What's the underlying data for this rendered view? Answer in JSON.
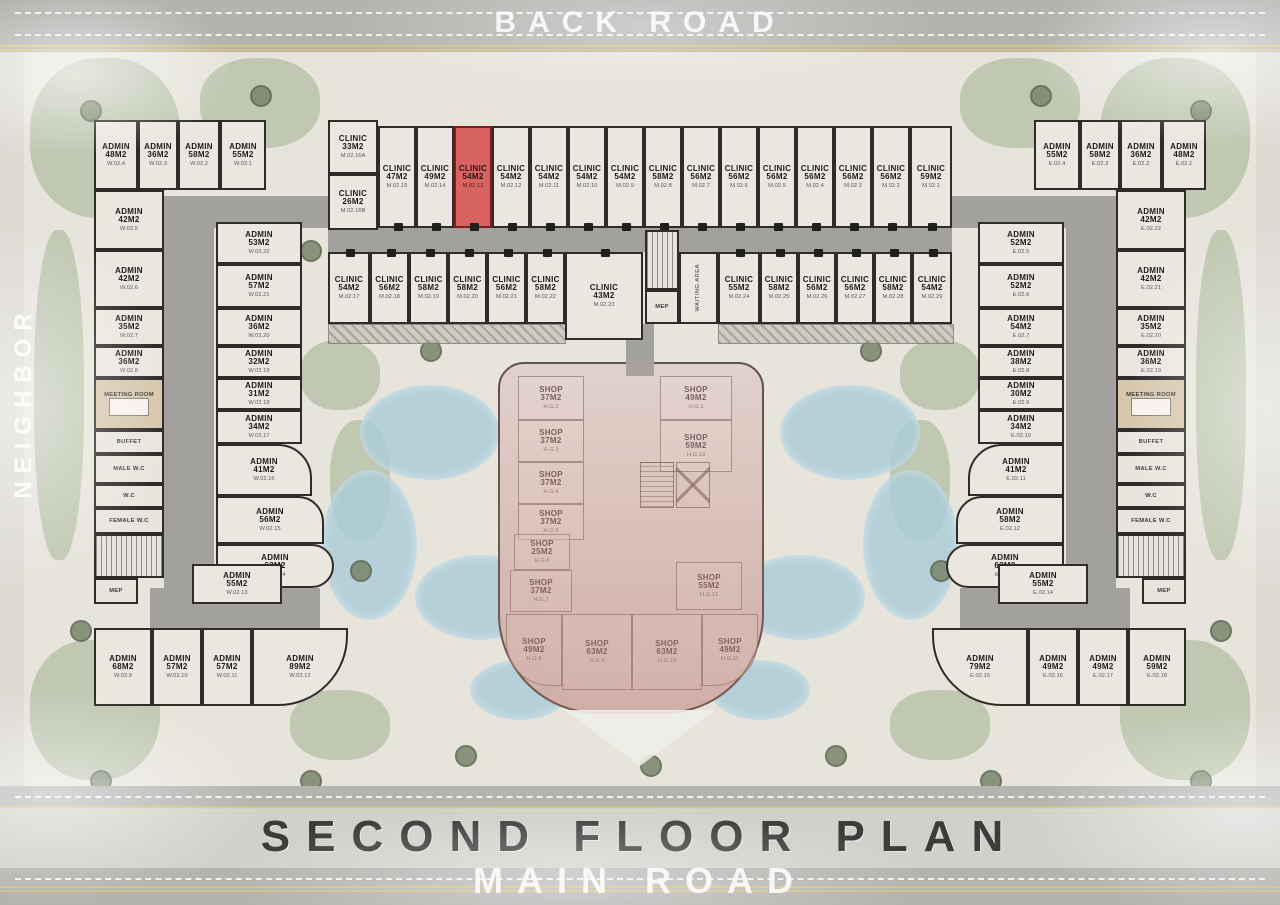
{
  "title": "SECOND FLOOR PLAN",
  "roads": {
    "top_label": "BACK ROAD",
    "bottom_label": "MAIN ROAD",
    "left_label": "NEIGHBOR"
  },
  "highlighted_unit": {
    "type": "CLINIC",
    "area": "54M2",
    "code": "M.02.13",
    "color": "#d96361"
  },
  "plan": {
    "corridors": [
      {
        "x": 150,
        "y": 196,
        "w": 182,
        "h": 32
      },
      {
        "x": 328,
        "y": 228,
        "w": 624,
        "h": 24
      },
      {
        "x": 950,
        "y": 196,
        "w": 182,
        "h": 32
      },
      {
        "x": 164,
        "y": 196,
        "w": 50,
        "h": 392
      },
      {
        "x": 150,
        "y": 588,
        "w": 170,
        "h": 50
      },
      {
        "x": 200,
        "y": 638,
        "w": 64,
        "h": 30
      },
      {
        "x": 1066,
        "y": 196,
        "w": 50,
        "h": 392
      },
      {
        "x": 960,
        "y": 588,
        "w": 170,
        "h": 50
      },
      {
        "x": 1016,
        "y": 638,
        "w": 64,
        "h": 30
      },
      {
        "x": 626,
        "y": 324,
        "w": 28,
        "h": 52
      }
    ],
    "hatches": [
      {
        "x": 718,
        "y": 324,
        "w": 234,
        "h": 18
      },
      {
        "x": 328,
        "y": 324,
        "w": 236,
        "h": 18
      }
    ],
    "rooms": [
      {
        "t": "ADMIN",
        "a": "48M2",
        "c": "W.02.4",
        "x": 94,
        "y": 120,
        "w": 44,
        "h": 70,
        "k": "u"
      },
      {
        "t": "ADMIN",
        "a": "36M2",
        "c": "W.02.3",
        "x": 138,
        "y": 120,
        "w": 40,
        "h": 70,
        "k": "u"
      },
      {
        "t": "ADMIN",
        "a": "58M2",
        "c": "W.02.2",
        "x": 178,
        "y": 120,
        "w": 42,
        "h": 70,
        "k": "u"
      },
      {
        "t": "ADMIN",
        "a": "55M2",
        "c": "W.02.1",
        "x": 220,
        "y": 120,
        "w": 46,
        "h": 70,
        "k": "u"
      },
      {
        "t": "ADMIN",
        "a": "55M2",
        "c": "E.02.4",
        "x": 1034,
        "y": 120,
        "w": 46,
        "h": 70,
        "k": "u"
      },
      {
        "t": "ADMIN",
        "a": "58M2",
        "c": "E.02.3",
        "x": 1080,
        "y": 120,
        "w": 40,
        "h": 70,
        "k": "u"
      },
      {
        "t": "ADMIN",
        "a": "36M2",
        "c": "E.02.2",
        "x": 1120,
        "y": 120,
        "w": 42,
        "h": 70,
        "k": "u"
      },
      {
        "t": "ADMIN",
        "a": "48M2",
        "c": "E.02.1",
        "x": 1162,
        "y": 120,
        "w": 44,
        "h": 70,
        "k": "u"
      },
      {
        "t": "CLINIC",
        "a": "33M2",
        "c": "M.02.16A",
        "x": 328,
        "y": 120,
        "w": 50,
        "h": 54,
        "k": "u"
      },
      {
        "t": "CLINIC",
        "a": "26M2",
        "c": "M.02.16B",
        "x": 328,
        "y": 174,
        "w": 50,
        "h": 56,
        "k": "u"
      },
      {
        "t": "CLINIC",
        "a": "47M2",
        "c": "M.02.15",
        "x": 378,
        "y": 126,
        "w": 38,
        "h": 102,
        "k": "u",
        "d": "b"
      },
      {
        "t": "CLINIC",
        "a": "49M2",
        "c": "M.02.14",
        "x": 416,
        "y": 126,
        "w": 38,
        "h": 102,
        "k": "u",
        "d": "b"
      },
      {
        "t": "CLINIC",
        "a": "54M2",
        "c": "M.02.13",
        "x": 454,
        "y": 126,
        "w": 38,
        "h": 102,
        "k": "red",
        "d": "b"
      },
      {
        "t": "CLINIC",
        "a": "54M2",
        "c": "M.02.12",
        "x": 492,
        "y": 126,
        "w": 38,
        "h": 102,
        "k": "u",
        "d": "b"
      },
      {
        "t": "CLINIC",
        "a": "54M2",
        "c": "M.02.11",
        "x": 530,
        "y": 126,
        "w": 38,
        "h": 102,
        "k": "u",
        "d": "b"
      },
      {
        "t": "CLINIC",
        "a": "54M2",
        "c": "M.02.10",
        "x": 568,
        "y": 126,
        "w": 38,
        "h": 102,
        "k": "u",
        "d": "b"
      },
      {
        "t": "CLINIC",
        "a": "54M2",
        "c": "M.02.9",
        "x": 606,
        "y": 126,
        "w": 38,
        "h": 102,
        "k": "u",
        "d": "b"
      },
      {
        "t": "CLINIC",
        "a": "58M2",
        "c": "M.02.8",
        "x": 644,
        "y": 126,
        "w": 38,
        "h": 102,
        "k": "u",
        "d": "b"
      },
      {
        "t": "CLINIC",
        "a": "56M2",
        "c": "M.02.7",
        "x": 682,
        "y": 126,
        "w": 38,
        "h": 102,
        "k": "u",
        "d": "b"
      },
      {
        "t": "CLINIC",
        "a": "56M2",
        "c": "M.02.6",
        "x": 720,
        "y": 126,
        "w": 38,
        "h": 102,
        "k": "u",
        "d": "b"
      },
      {
        "t": "CLINIC",
        "a": "56M2",
        "c": "M.02.5",
        "x": 758,
        "y": 126,
        "w": 38,
        "h": 102,
        "k": "u",
        "d": "b"
      },
      {
        "t": "CLINIC",
        "a": "56M2",
        "c": "M.02.4",
        "x": 796,
        "y": 126,
        "w": 38,
        "h": 102,
        "k": "u",
        "d": "b"
      },
      {
        "t": "CLINIC",
        "a": "56M2",
        "c": "M.02.3",
        "x": 834,
        "y": 126,
        "w": 38,
        "h": 102,
        "k": "u",
        "d": "b"
      },
      {
        "t": "CLINIC",
        "a": "56M2",
        "c": "M.02.2",
        "x": 872,
        "y": 126,
        "w": 38,
        "h": 102,
        "k": "u",
        "d": "b"
      },
      {
        "t": "CLINIC",
        "a": "59M2",
        "c": "M.02.1",
        "x": 910,
        "y": 126,
        "w": 42,
        "h": 102,
        "k": "u",
        "d": "b"
      },
      {
        "t": "CLINIC",
        "a": "54M2",
        "c": "M.02.17",
        "x": 328,
        "y": 252,
        "w": 42,
        "h": 72,
        "k": "u",
        "d": "t"
      },
      {
        "t": "CLINIC",
        "a": "56M2",
        "c": "M.02.18",
        "x": 370,
        "y": 252,
        "w": 39,
        "h": 72,
        "k": "u",
        "d": "t"
      },
      {
        "t": "CLINIC",
        "a": "58M2",
        "c": "M.02.19",
        "x": 409,
        "y": 252,
        "w": 39,
        "h": 72,
        "k": "u",
        "d": "t"
      },
      {
        "t": "CLINIC",
        "a": "58M2",
        "c": "M.02.20",
        "x": 448,
        "y": 252,
        "w": 39,
        "h": 72,
        "k": "u",
        "d": "t"
      },
      {
        "t": "CLINIC",
        "a": "56M2",
        "c": "M.02.21",
        "x": 487,
        "y": 252,
        "w": 39,
        "h": 72,
        "k": "u",
        "d": "t"
      },
      {
        "t": "CLINIC",
        "a": "58M2",
        "c": "M.02.22",
        "x": 526,
        "y": 252,
        "w": 39,
        "h": 72,
        "k": "u",
        "d": "t"
      },
      {
        "t": "CLINIC",
        "a": "43M2",
        "c": "M.02.23",
        "x": 565,
        "y": 252,
        "w": 78,
        "h": 88,
        "k": "u",
        "d": "t"
      },
      {
        "t": "CLINIC",
        "a": "55M2",
        "c": "M.02.24",
        "x": 718,
        "y": 252,
        "w": 42,
        "h": 72,
        "k": "u",
        "d": "t"
      },
      {
        "t": "CLINIC",
        "a": "58M2",
        "c": "M.02.25",
        "x": 760,
        "y": 252,
        "w": 38,
        "h": 72,
        "k": "u",
        "d": "t"
      },
      {
        "t": "CLINIC",
        "a": "56M2",
        "c": "M.02.26",
        "x": 798,
        "y": 252,
        "w": 38,
        "h": 72,
        "k": "u",
        "d": "t"
      },
      {
        "t": "CLINIC",
        "a": "56M2",
        "c": "M.02.27",
        "x": 836,
        "y": 252,
        "w": 38,
        "h": 72,
        "k": "u",
        "d": "t"
      },
      {
        "t": "CLINIC",
        "a": "58M2",
        "c": "M.02.28",
        "x": 874,
        "y": 252,
        "w": 38,
        "h": 72,
        "k": "u",
        "d": "t"
      },
      {
        "t": "CLINIC",
        "a": "54M2",
        "c": "M.02.29",
        "x": 912,
        "y": 252,
        "w": 40,
        "h": 72,
        "k": "u",
        "d": "t"
      },
      {
        "t": "ADMIN",
        "a": "42M2",
        "c": "W.02.5",
        "x": 94,
        "y": 190,
        "w": 70,
        "h": 60,
        "k": "u"
      },
      {
        "t": "ADMIN",
        "a": "42M2",
        "c": "W.02.6",
        "x": 94,
        "y": 250,
        "w": 70,
        "h": 58,
        "k": "u"
      },
      {
        "t": "ADMIN",
        "a": "35M2",
        "c": "W.02.7",
        "x": 94,
        "y": 308,
        "w": 70,
        "h": 38,
        "k": "u"
      },
      {
        "t": "ADMIN",
        "a": "36M2",
        "c": "W.02.8",
        "x": 94,
        "y": 346,
        "w": 70,
        "h": 32,
        "k": "u"
      },
      {
        "n": "MEETING ROOM",
        "x": 94,
        "y": 378,
        "w": 70,
        "h": 52,
        "k": "s meeting"
      },
      {
        "n": "BUFFET",
        "x": 94,
        "y": 430,
        "w": 70,
        "h": 24,
        "k": "s"
      },
      {
        "n": "MALE W.C",
        "x": 94,
        "y": 454,
        "w": 70,
        "h": 30,
        "k": "s"
      },
      {
        "n": "W.C",
        "x": 94,
        "y": 484,
        "w": 70,
        "h": 24,
        "k": "s"
      },
      {
        "n": "FEMALE W.C",
        "x": 94,
        "y": 508,
        "w": 70,
        "h": 26,
        "k": "s"
      },
      {
        "n": "",
        "x": 94,
        "y": 534,
        "w": 70,
        "h": 44,
        "k": "st"
      },
      {
        "n": "MEP",
        "x": 94,
        "y": 578,
        "w": 44,
        "h": 26,
        "k": "s"
      },
      {
        "t": "ADMIN",
        "a": "53M2",
        "c": "W.02.22",
        "x": 216,
        "y": 222,
        "w": 86,
        "h": 42,
        "k": "u"
      },
      {
        "t": "ADMIN",
        "a": "57M2",
        "c": "W.02.21",
        "x": 216,
        "y": 264,
        "w": 86,
        "h": 44,
        "k": "u"
      },
      {
        "t": "ADMIN",
        "a": "36M2",
        "c": "W.02.20",
        "x": 216,
        "y": 308,
        "w": 86,
        "h": 38,
        "k": "u"
      },
      {
        "t": "ADMIN",
        "a": "32M2",
        "c": "W.02.19",
        "x": 216,
        "y": 346,
        "w": 86,
        "h": 32,
        "k": "u"
      },
      {
        "t": "ADMIN",
        "a": "31M2",
        "c": "W.02.18",
        "x": 216,
        "y": 378,
        "w": 86,
        "h": 32,
        "k": "u"
      },
      {
        "t": "ADMIN",
        "a": "34M2",
        "c": "W.02.17",
        "x": 216,
        "y": 410,
        "w": 86,
        "h": 34,
        "k": "u"
      },
      {
        "t": "ADMIN",
        "a": "41M2",
        "c": "W.02.16",
        "x": 216,
        "y": 444,
        "w": 96,
        "h": 52,
        "k": "u",
        "r": "0 34px 0 0"
      },
      {
        "t": "ADMIN",
        "a": "56M2",
        "c": "W.02.15",
        "x": 216,
        "y": 496,
        "w": 108,
        "h": 48,
        "k": "u",
        "r": "0 26px 0 0"
      },
      {
        "t": "ADMIN",
        "a": "63M2",
        "c": "W.02.14",
        "x": 216,
        "y": 544,
        "w": 118,
        "h": 44,
        "k": "u",
        "r": "0 22px 22px 0"
      },
      {
        "t": "ADMIN",
        "a": "55M2",
        "c": "W.02.13",
        "x": 192,
        "y": 564,
        "w": 90,
        "h": 40,
        "k": "u"
      },
      {
        "t": "ADMIN",
        "a": "68M2",
        "c": "W.02.9",
        "x": 94,
        "y": 628,
        "w": 58,
        "h": 78,
        "k": "u"
      },
      {
        "t": "ADMIN",
        "a": "57M2",
        "c": "W.02.10",
        "x": 152,
        "y": 628,
        "w": 50,
        "h": 78,
        "k": "u"
      },
      {
        "t": "ADMIN",
        "a": "57M2",
        "c": "W.02.11",
        "x": 202,
        "y": 628,
        "w": 50,
        "h": 78,
        "k": "u"
      },
      {
        "t": "ADMIN",
        "a": "89M2",
        "c": "W.02.12",
        "x": 252,
        "y": 628,
        "w": 96,
        "h": 78,
        "k": "u",
        "r": "0 0 70px 0"
      },
      {
        "t": "ADMIN",
        "a": "52M2",
        "c": "E.02.5",
        "x": 978,
        "y": 222,
        "w": 86,
        "h": 42,
        "k": "u"
      },
      {
        "t": "ADMIN",
        "a": "52M2",
        "c": "E.02.6",
        "x": 978,
        "y": 264,
        "w": 86,
        "h": 44,
        "k": "u"
      },
      {
        "t": "ADMIN",
        "a": "54M2",
        "c": "E.02.7",
        "x": 978,
        "y": 308,
        "w": 86,
        "h": 38,
        "k": "u"
      },
      {
        "t": "ADMIN",
        "a": "38M2",
        "c": "E.02.8",
        "x": 978,
        "y": 346,
        "w": 86,
        "h": 32,
        "k": "u"
      },
      {
        "t": "ADMIN",
        "a": "30M2",
        "c": "E.02.9",
        "x": 978,
        "y": 378,
        "w": 86,
        "h": 32,
        "k": "u"
      },
      {
        "t": "ADMIN",
        "a": "34M2",
        "c": "E.02.10",
        "x": 978,
        "y": 410,
        "w": 86,
        "h": 34,
        "k": "u"
      },
      {
        "t": "ADMIN",
        "a": "41M2",
        "c": "E.02.11",
        "x": 968,
        "y": 444,
        "w": 96,
        "h": 52,
        "k": "u",
        "r": "34px 0 0 0"
      },
      {
        "t": "ADMIN",
        "a": "58M2",
        "c": "E.02.12",
        "x": 956,
        "y": 496,
        "w": 108,
        "h": 48,
        "k": "u",
        "r": "26px 0 0 0"
      },
      {
        "t": "ADMIN",
        "a": "63M2",
        "c": "E.02.13",
        "x": 946,
        "y": 544,
        "w": 118,
        "h": 44,
        "k": "u",
        "r": "22px 0 0 22px"
      },
      {
        "t": "ADMIN",
        "a": "55M2",
        "c": "E.02.14",
        "x": 998,
        "y": 564,
        "w": 90,
        "h": 40,
        "k": "u"
      },
      {
        "t": "ADMIN",
        "a": "79M2",
        "c": "E.02.15",
        "x": 932,
        "y": 628,
        "w": 96,
        "h": 78,
        "k": "u",
        "r": "0 0 0 70px"
      },
      {
        "t": "ADMIN",
        "a": "49M2",
        "c": "E.02.16",
        "x": 1028,
        "y": 628,
        "w": 50,
        "h": 78,
        "k": "u"
      },
      {
        "t": "ADMIN",
        "a": "49M2",
        "c": "E.02.17",
        "x": 1078,
        "y": 628,
        "w": 50,
        "h": 78,
        "k": "u"
      },
      {
        "t": "ADMIN",
        "a": "59M2",
        "c": "E.02.18",
        "x": 1128,
        "y": 628,
        "w": 58,
        "h": 78,
        "k": "u"
      },
      {
        "t": "ADMIN",
        "a": "42M2",
        "c": "E.02.22",
        "x": 1116,
        "y": 190,
        "w": 70,
        "h": 60,
        "k": "u"
      },
      {
        "t": "ADMIN",
        "a": "42M2",
        "c": "E.02.21",
        "x": 1116,
        "y": 250,
        "w": 70,
        "h": 58,
        "k": "u"
      },
      {
        "t": "ADMIN",
        "a": "35M2",
        "c": "E.02.20",
        "x": 1116,
        "y": 308,
        "w": 70,
        "h": 38,
        "k": "u"
      },
      {
        "t": "ADMIN",
        "a": "36M2",
        "c": "E.02.19",
        "x": 1116,
        "y": 346,
        "w": 70,
        "h": 32,
        "k": "u"
      },
      {
        "n": "MEETING ROOM",
        "x": 1116,
        "y": 378,
        "w": 70,
        "h": 52,
        "k": "s meeting"
      },
      {
        "n": "BUFFET",
        "x": 1116,
        "y": 430,
        "w": 70,
        "h": 24,
        "k": "s"
      },
      {
        "n": "MALE W.C",
        "x": 1116,
        "y": 454,
        "w": 70,
        "h": 30,
        "k": "s"
      },
      {
        "n": "W.C",
        "x": 1116,
        "y": 484,
        "w": 70,
        "h": 24,
        "k": "s"
      },
      {
        "n": "FEMALE W.C",
        "x": 1116,
        "y": 508,
        "w": 70,
        "h": 26,
        "k": "s"
      },
      {
        "n": "",
        "x": 1116,
        "y": 534,
        "w": 70,
        "h": 44,
        "k": "st"
      },
      {
        "n": "MEP",
        "x": 1142,
        "y": 578,
        "w": 44,
        "h": 26,
        "k": "s"
      },
      {
        "n": "",
        "x": 645,
        "y": 230,
        "w": 34,
        "h": 60,
        "k": "st"
      },
      {
        "n": "MEP",
        "x": 645,
        "y": 290,
        "w": 34,
        "h": 34,
        "k": "s"
      },
      {
        "n": "WAITING AREA",
        "x": 679,
        "y": 252,
        "w": 39,
        "h": 72,
        "k": "w"
      },
      {
        "t": "SHOP",
        "a": "37M2",
        "c": "H.G.2",
        "x": 518,
        "y": 376,
        "w": 66,
        "h": 44,
        "k": "sh"
      },
      {
        "t": "SHOP",
        "a": "37M2",
        "c": "H.G.3",
        "x": 518,
        "y": 420,
        "w": 66,
        "h": 42,
        "k": "sh"
      },
      {
        "t": "SHOP",
        "a": "37M2",
        "c": "H.G.4",
        "x": 518,
        "y": 462,
        "w": 66,
        "h": 42,
        "k": "sh"
      },
      {
        "t": "SHOP",
        "a": "37M2",
        "c": "H.G.5",
        "x": 518,
        "y": 504,
        "w": 66,
        "h": 36,
        "k": "sh"
      },
      {
        "t": "SHOP",
        "a": "49M2",
        "c": "H.G.1",
        "x": 660,
        "y": 376,
        "w": 72,
        "h": 44,
        "k": "sh"
      },
      {
        "t": "SHOP",
        "a": "59M2",
        "c": "H.G.13",
        "x": 660,
        "y": 420,
        "w": 72,
        "h": 52,
        "k": "sh"
      },
      {
        "t": "SHOP",
        "a": "25M2",
        "c": "H.G.6",
        "x": 514,
        "y": 534,
        "w": 56,
        "h": 36,
        "k": "sh"
      },
      {
        "t": "SHOP",
        "a": "37M2",
        "c": "H.G.7",
        "x": 510,
        "y": 570,
        "w": 62,
        "h": 42,
        "k": "sh"
      },
      {
        "t": "SHOP",
        "a": "55M2",
        "c": "H.G.12",
        "x": 676,
        "y": 562,
        "w": 66,
        "h": 48,
        "k": "sh"
      },
      {
        "t": "SHOP",
        "a": "49M2",
        "c": "H.G.8",
        "x": 506,
        "y": 614,
        "w": 56,
        "h": 72,
        "k": "sh",
        "r": "0 0 0 44px"
      },
      {
        "t": "SHOP",
        "a": "63M2",
        "c": "H.G.9",
        "x": 562,
        "y": 614,
        "w": 70,
        "h": 76,
        "k": "sh"
      },
      {
        "t": "SHOP",
        "a": "63M2",
        "c": "H.G.10",
        "x": 632,
        "y": 614,
        "w": 70,
        "h": 76,
        "k": "sh"
      },
      {
        "t": "SHOP",
        "a": "49M2",
        "c": "H.G.11",
        "x": 702,
        "y": 614,
        "w": 56,
        "h": 72,
        "k": "sh",
        "r": "0 0 44px 0"
      }
    ]
  }
}
